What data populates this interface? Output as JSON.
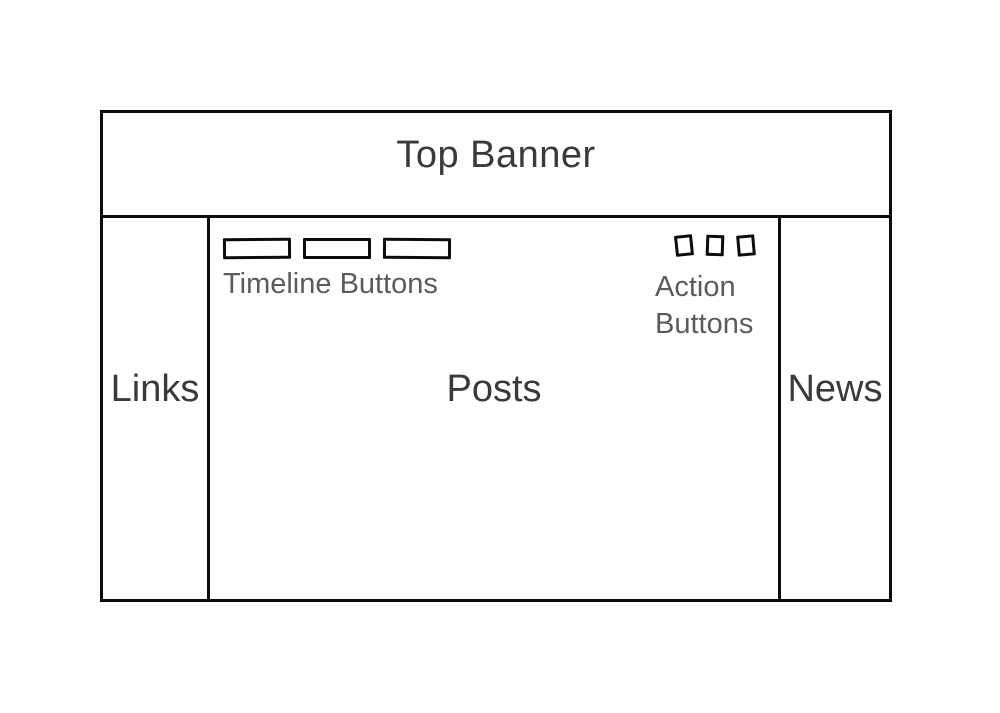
{
  "canvas": {
    "background": "#ffffff"
  },
  "wireframe": {
    "banner": {
      "label": "Top Banner"
    },
    "left_sidebar": {
      "label": "Links"
    },
    "main": {
      "timeline_buttons": {
        "label": "Timeline Buttons",
        "count": 3
      },
      "action_buttons": {
        "label_line1": "Action",
        "label_line2": "Buttons",
        "count": 3
      },
      "posts": {
        "label": "Posts"
      }
    },
    "right_sidebar": {
      "label": "News"
    }
  },
  "colors": {
    "line": "#0c0c0c",
    "heading_text": "#3a3a3a",
    "caption_text": "#5c5c5c",
    "background": "#ffffff"
  }
}
